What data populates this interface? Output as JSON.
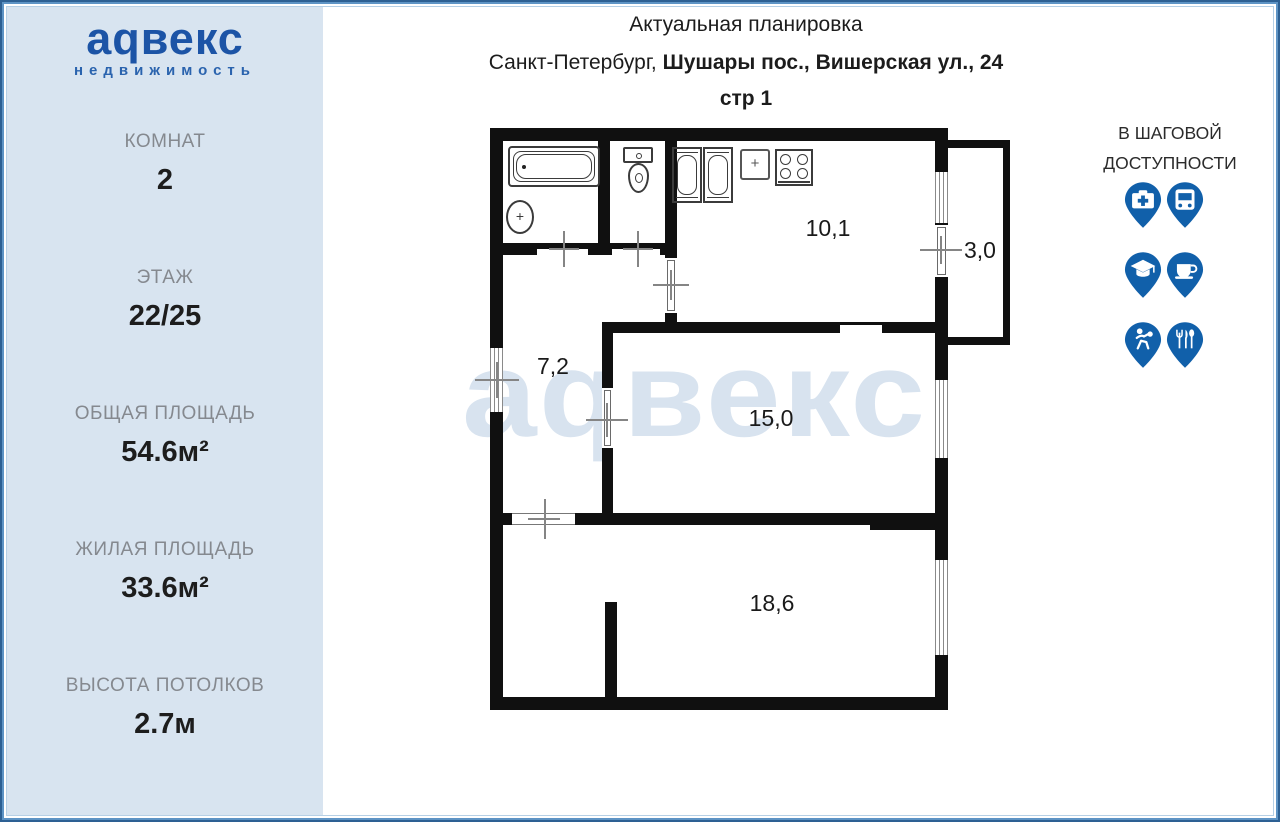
{
  "sidebar": {
    "logo": {
      "brand": "аqвекс",
      "subtitle": "недвижимость"
    },
    "stats": [
      {
        "label": "КОМНАТ",
        "value": "2"
      },
      {
        "label": "ЭТАЖ",
        "value": "22/25"
      },
      {
        "label": "ОБЩАЯ ПЛОЩАДЬ",
        "value": "54.6м²"
      },
      {
        "label": "ЖИЛАЯ ПЛОЩАДЬ",
        "value": "33.6м²"
      },
      {
        "label": "ВЫСОТА ПОТОЛКОВ",
        "value": "2.7м"
      }
    ]
  },
  "header": {
    "title": "Актуальная планировка",
    "address_regular": "Санкт-Петербург, ",
    "address_bold": "Шушары пос., Вишерская ул., 24",
    "building": "стр 1"
  },
  "floorplan": {
    "watermark": "аqвекс",
    "rooms": [
      {
        "name": "kitchen",
        "area": "10,1"
      },
      {
        "name": "balcony",
        "area": "3,0"
      },
      {
        "name": "hallway",
        "area": "7,2"
      },
      {
        "name": "living-room",
        "area": "15,0"
      },
      {
        "name": "bedroom",
        "area": "18,6"
      }
    ]
  },
  "nearby": {
    "title_line1": "В ШАГОВОЙ",
    "title_line2": "ДОСТУПНОСТИ",
    "icons": [
      {
        "name": "hospital-pin"
      },
      {
        "name": "bus-pin"
      },
      {
        "name": "education-pin"
      },
      {
        "name": "cafe-pin"
      },
      {
        "name": "sport-pin"
      },
      {
        "name": "restaurant-pin"
      }
    ]
  },
  "colors": {
    "logo_blue": "#1c54a6",
    "pin_blue": "#1160aa",
    "sidebar_bg": "#d8e4f0",
    "watermark": "#d8e3ef",
    "wall": "#101010",
    "frame_blue": "#5e94c5"
  }
}
